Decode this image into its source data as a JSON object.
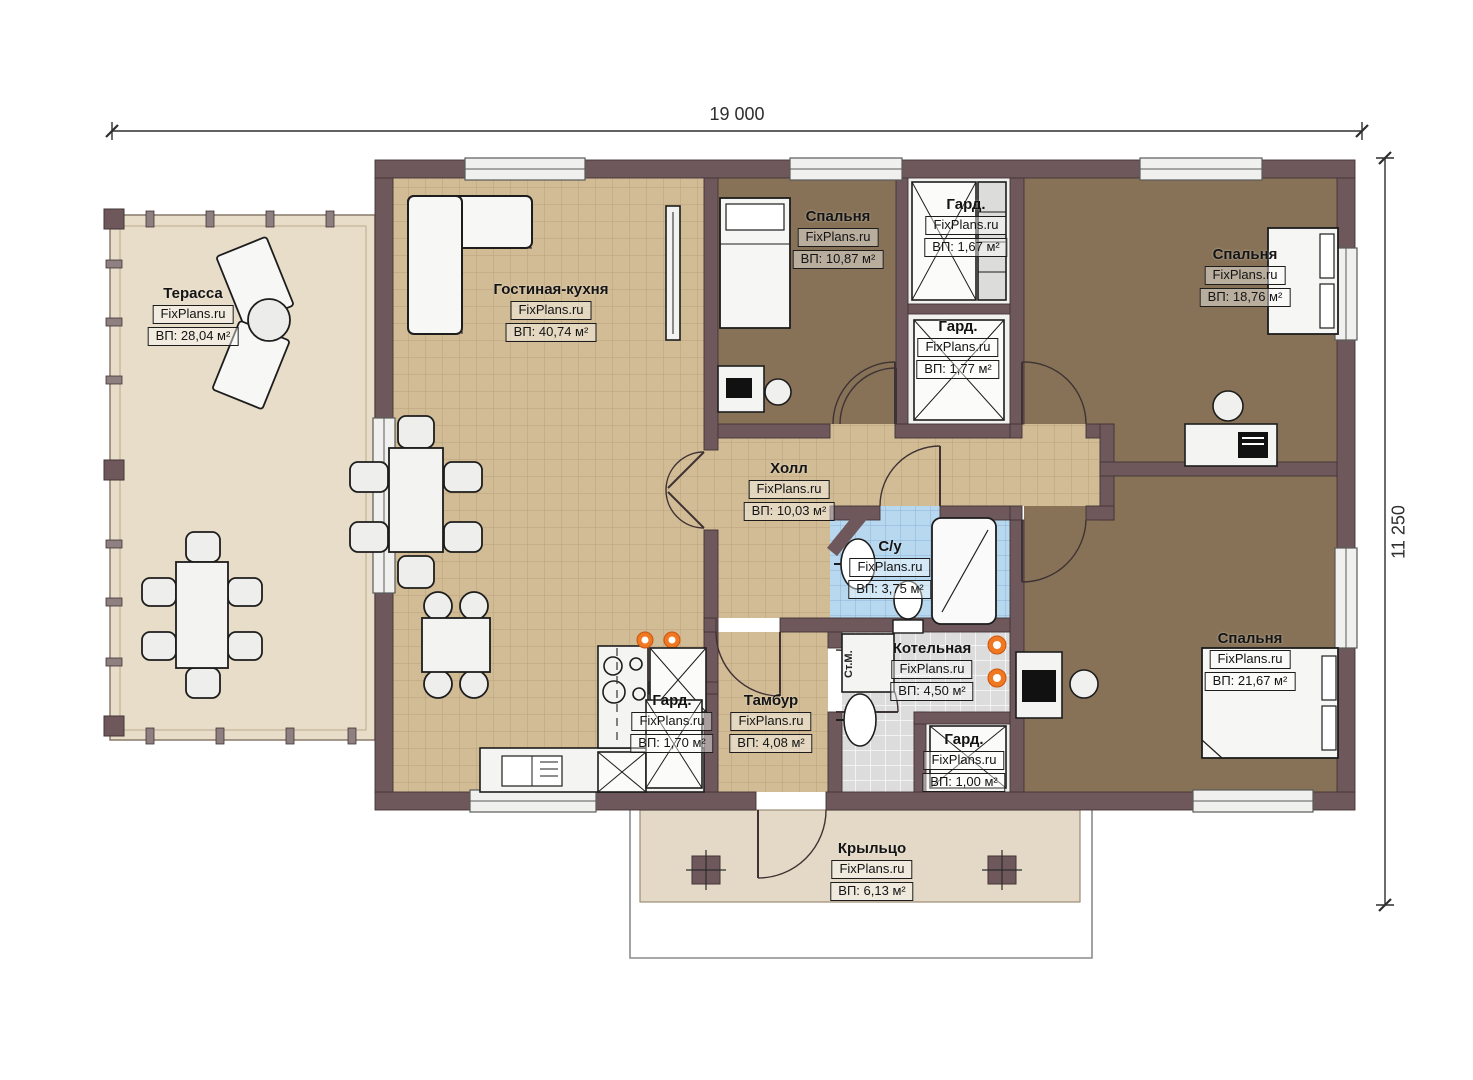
{
  "brand": "FixPlans.ru",
  "dimensions": {
    "width_label": "19 000",
    "height_label": "11 250"
  },
  "annotations": {
    "washing_machine": "Ст.М."
  },
  "rooms": [
    {
      "id": "terrace",
      "name": "Терасса",
      "area": "ВП: 28,04 м²"
    },
    {
      "id": "living-kitchen",
      "name": "Гостиная-кухня",
      "area": "ВП: 40,74 м²"
    },
    {
      "id": "bedroom-top",
      "name": "Спальня",
      "area": "ВП: 10,87 м²"
    },
    {
      "id": "wardrobe-1",
      "name": "Гард.",
      "area": "ВП: 1,67 м²"
    },
    {
      "id": "wardrobe-2",
      "name": "Гард.",
      "area": "ВП: 1,77 м²"
    },
    {
      "id": "bedroom-right",
      "name": "Спальня",
      "area": "ВП: 18,76 м²"
    },
    {
      "id": "hall",
      "name": "Холл",
      "area": "ВП: 10,03 м²"
    },
    {
      "id": "bathroom",
      "name": "С/у",
      "area": "ВП: 3,75 м²"
    },
    {
      "id": "boiler",
      "name": "Котельная",
      "area": "ВП: 4,50 м²"
    },
    {
      "id": "bedroom-bottom",
      "name": "Спальня",
      "area": "ВП: 21,67 м²"
    },
    {
      "id": "wardrobe-3",
      "name": "Гард.",
      "area": "ВП: 1,70 м²"
    },
    {
      "id": "tambour",
      "name": "Тамбур",
      "area": "ВП: 4,08 м²"
    },
    {
      "id": "wardrobe-4",
      "name": "Гард.",
      "area": "ВП: 1,00 м²"
    },
    {
      "id": "porch",
      "name": "Крыльцо",
      "area": "ВП: 6,13 м²"
    }
  ],
  "colors": {
    "wall": "#6f585b",
    "wall_edge": "#423436",
    "tile_tan": "#d2bc95",
    "tile_blue": "#b7d8ef",
    "tile_gray": "#dcdcdc",
    "bedroom_floor": "#877257",
    "terrace_floor": "#e8ddc8",
    "porch_floor": "#e3d9c6",
    "closet_floor": "#f1f1ef",
    "accent_orange": "#f07820"
  }
}
